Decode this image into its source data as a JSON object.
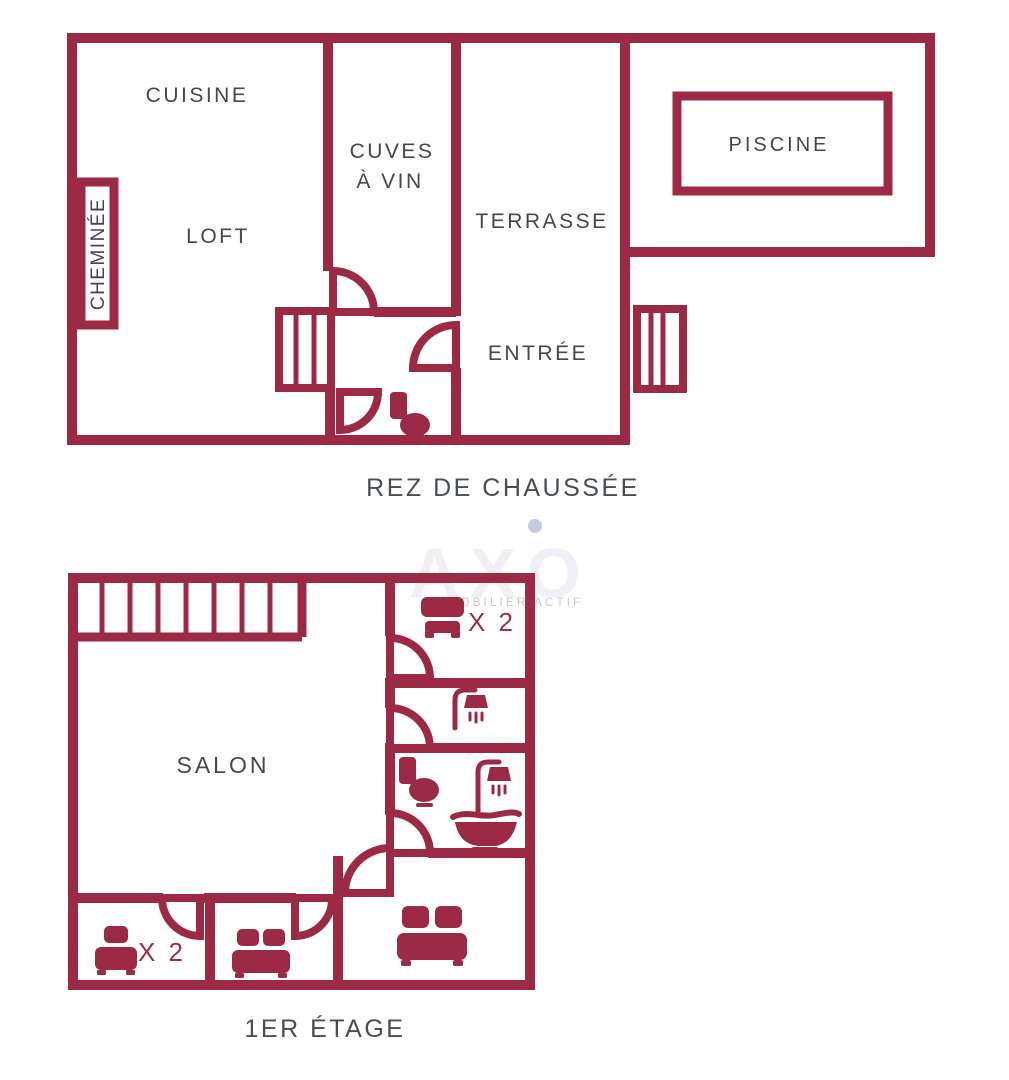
{
  "colors": {
    "wall": "#9c2a44",
    "label": "#43484e",
    "caption": "#494e54",
    "multiplier": "#9f2d48",
    "watermark": "#e4e7ef",
    "tagline": "#cbc5c8",
    "dot": "#c5cada"
  },
  "ground_floor": {
    "caption": "REZ DE CHAUSSÉE",
    "rooms": {
      "cuisine": "CUISINE",
      "loft": "LOFT",
      "cheminee": "CHEMINÉE",
      "cuves_line1": "CUVES",
      "cuves_line2": "À VIN",
      "terrasse": "TERRASSE",
      "entree": "ENTRÉE",
      "piscine": "PISCINE"
    }
  },
  "first_floor": {
    "caption": "1ER ÉTAGE",
    "rooms": {
      "salon": "SALON"
    },
    "bed_top_multiplier": "X 2",
    "bed_left_multiplier": "X 2"
  },
  "watermark": {
    "brand": "AXO",
    "tagline": "IMMOBILIER ACTIF"
  }
}
